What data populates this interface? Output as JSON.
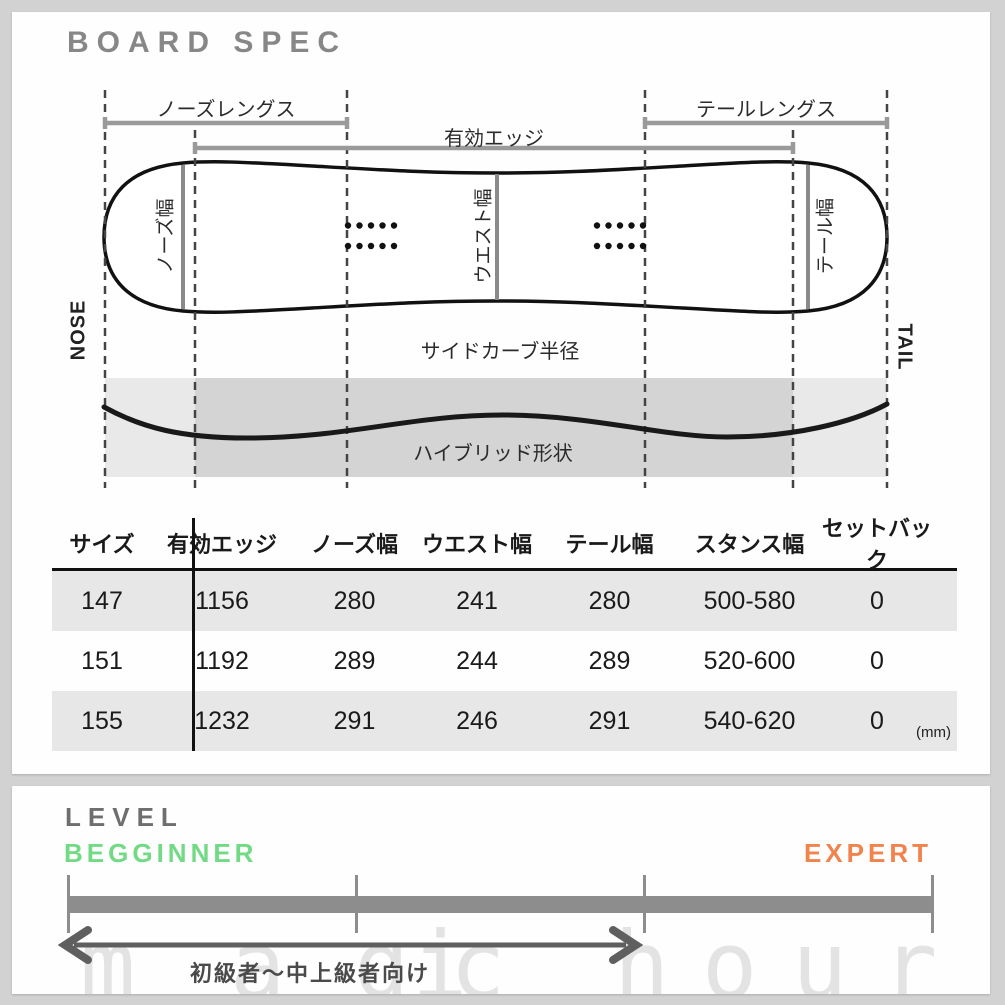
{
  "board_spec": {
    "title": "BOARD SPEC",
    "diagram": {
      "nose_length_label": "ノーズレングス",
      "effective_edge_label": "有効エッジ",
      "tail_length_label": "テールレングス",
      "nose_width_label": "ノーズ幅",
      "waist_width_label": "ウエスト幅",
      "tail_width_label": "テール幅",
      "sidecut_label": "サイドカーブ半径",
      "profile_label": "ハイブリッド形状",
      "nose_label": "NOSE",
      "tail_label": "TAIL"
    },
    "table": {
      "headers": [
        "サイズ",
        "有効エッジ",
        "ノーズ幅",
        "ウエスト幅",
        "テール幅",
        "スタンス幅",
        "セットバック"
      ],
      "rows": [
        [
          "147",
          "1156",
          "280",
          "241",
          "280",
          "500-580",
          "0"
        ],
        [
          "151",
          "1192",
          "289",
          "244",
          "289",
          "520-600",
          "0"
        ],
        [
          "155",
          "1232",
          "291",
          "246",
          "291",
          "540-620",
          "0"
        ]
      ],
      "unit_note": "(mm)"
    }
  },
  "level": {
    "title": "LEVEL",
    "beginner_label": "BEGGINNER",
    "expert_label": "EXPERT",
    "range_label": "初級者～中上級者向け"
  },
  "watermark": {
    "text": "magic hour",
    "letters": [
      "m",
      "a",
      "g",
      "i",
      "c",
      "h",
      "o",
      "u",
      "r"
    ]
  },
  "colors": {
    "beginner_green": "#72da85",
    "expert_orange": "#f1834c",
    "title_gray": "#878787",
    "row_stripe": "#e7e7e7",
    "level_bar": "#8d8d8d"
  }
}
